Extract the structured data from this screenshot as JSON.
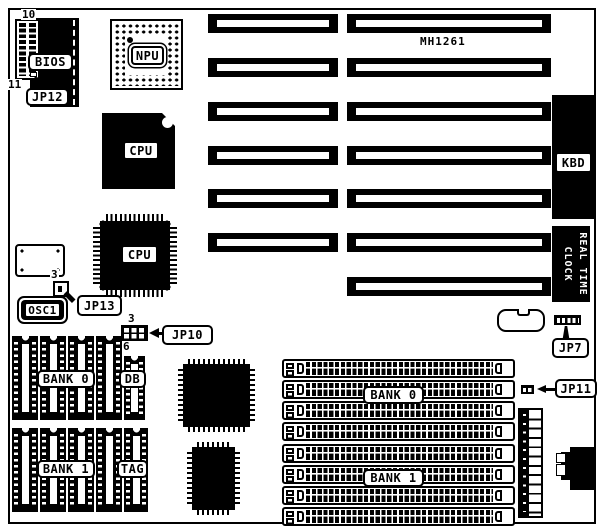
{
  "board": {
    "model": "MH1261",
    "expansion_slots": {
      "left_column_count": 6,
      "right_column_count": 7
    },
    "simm_slot_count": 8
  },
  "chips": {
    "bios": "BIOS",
    "npu": "NPU",
    "cpu_pga": "CPU",
    "cpu_qfp": "CPU",
    "osc1": "OSC1",
    "kbd": "KBD",
    "rtc_line1": "REAL TIME",
    "rtc_line2": "CLOCK"
  },
  "jumpers": {
    "jp7": "JP7",
    "jp10": "JP10",
    "jp11": "JP11",
    "jp12": "JP12",
    "jp13": "JP13"
  },
  "pin_numbers": {
    "jp12_top": "10",
    "jp12_bottom": "11",
    "jp13_pin3": "3",
    "jp10_pin3": "3",
    "jp10_pin6": "6"
  },
  "memory": {
    "dip_bank0": "BANK 0",
    "dip_bank1": "BANK 1",
    "data_buffer": "DB",
    "tag": "TAG",
    "simm_bank0": "BANK 0",
    "simm_bank1": "BANK 1"
  },
  "colors": {
    "ink": "#000000",
    "paper": "#ffffff"
  }
}
